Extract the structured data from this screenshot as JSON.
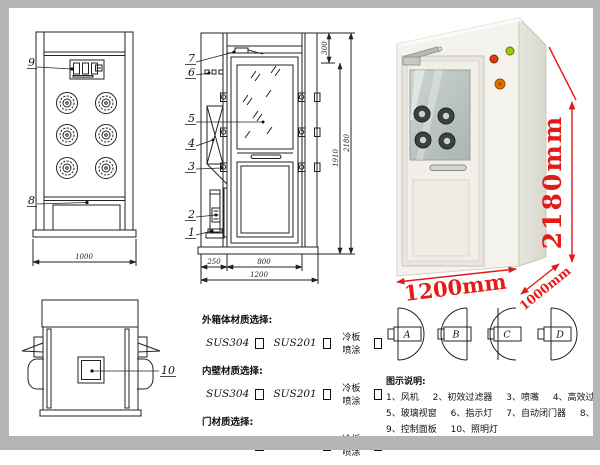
{
  "front_view": {
    "label_9": "9",
    "label_8": "8",
    "dim_width": "1000"
  },
  "side_view": {
    "label_7": "7",
    "label_6": "6",
    "label_5": "5",
    "label_4": "4",
    "label_3": "3",
    "label_2": "2",
    "label_1": "1",
    "dim_top": "300",
    "dim_door_height": "1910",
    "dim_total_height": "2180",
    "dim_left": "250",
    "dim_door_width": "800",
    "dim_total_width": "1200"
  },
  "top_view": {
    "label_10": "10"
  },
  "photo": {
    "dim_height": "2180mm",
    "dim_width": "1200mm",
    "dim_depth": "1000mm"
  },
  "materials": {
    "sections": [
      {
        "title": "外箱体材质选择:",
        "options": [
          "SUS304",
          "SUS201",
          "冷板喷涂"
        ]
      },
      {
        "title": "内壁材质选择:",
        "options": [
          "SUS304",
          "SUS201",
          "冷板喷涂"
        ]
      },
      {
        "title": "门材质选择:",
        "options": [
          "SUS304",
          "SUS201",
          "冷板喷涂"
        ]
      }
    ]
  },
  "door_options": [
    "A",
    "B",
    "C",
    "D"
  ],
  "legend": {
    "title": "图示说明:",
    "items": [
      "1、风机",
      "2、初效过滤器",
      "3、喷嘴",
      "4、高效过滤器",
      "5、玻璃视窗",
      "6、指示灯",
      "7、自动闭门器",
      "8、红外线感应器",
      "9、控制面板",
      "10、照明灯"
    ]
  }
}
